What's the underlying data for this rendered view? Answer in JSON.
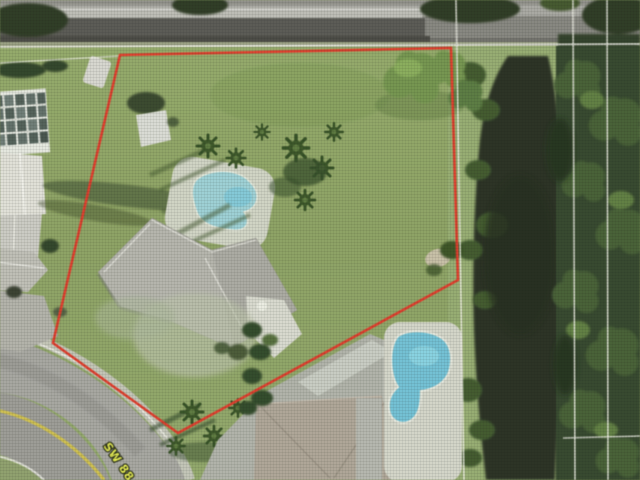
{
  "map": {
    "street_label": "SW 88",
    "boundary": {
      "color": "#e63422",
      "points": "120,55 451,48 458,280 178,433 53,343",
      "stroke_width": 2.6
    },
    "survey_lines": {
      "color": "#f1f1e9",
      "vertical_x": [
        461,
        573,
        607
      ],
      "horizontal_y": [
        46
      ],
      "right_segment_y": 437
    },
    "palette": {
      "lawn": "#8ba361",
      "highway": "#555550",
      "street": "#a6a6a0",
      "street_centerline_yellow": "#d3c240",
      "canal_water": "#222b1b",
      "tree_dark_green": "#2e4226",
      "pool_water": "#8fd2da",
      "neighbor_pool_water": "#6cc2d8",
      "pool_deck": "#d5d7ca",
      "main_roof_gray": "#b5b5ad",
      "neighbor_roof_tan": "#aea596",
      "label_yellow": "#e8ef49"
    },
    "features": [
      "highway-top",
      "parcel-boundary",
      "parcel-lawn",
      "garden-shed",
      "screened-enclosure",
      "neighbor-house-left",
      "main-house-roof",
      "kidney-pool",
      "pool-deck",
      "palm-trees",
      "canal",
      "tree-line-right",
      "survey-lines",
      "curved-street",
      "street-centerline",
      "street-label",
      "neighbor-pool",
      "neighbor-pool-deck",
      "neighbor-roof-bottom",
      "driveway"
    ]
  }
}
